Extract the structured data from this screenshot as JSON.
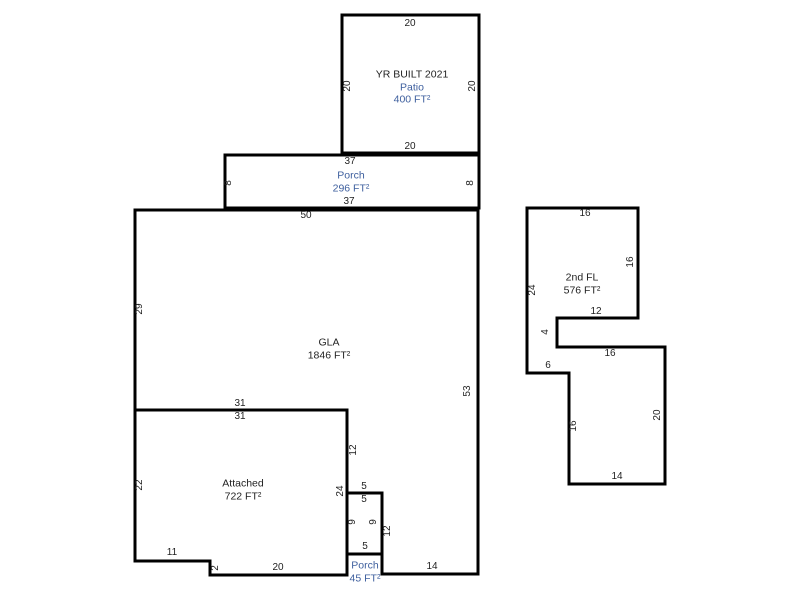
{
  "sketch": {
    "colors": {
      "background": "#ffffff",
      "wall": "#000000",
      "dimension_text": "#1f1f1f",
      "gla_label_text": "#1f1f1f",
      "non_gla_label_text": "#3e5f9e"
    },
    "areas": {
      "patio": {
        "note": "YR BUILT 2021",
        "name": "Patio",
        "size": "400 FT²"
      },
      "porch_upper": {
        "name": "Porch",
        "size": "296 FT²"
      },
      "gla": {
        "name": "GLA",
        "size": "1846 FT²"
      },
      "attached": {
        "name": "Attached",
        "size": "722 FT²"
      },
      "porch_lower": {
        "name": "Porch",
        "size": "45 FT²"
      },
      "second_floor": {
        "name": "2nd FL",
        "size": "576 FT²"
      }
    },
    "dimensions": [
      {
        "value": "20",
        "x": 410,
        "y": 24,
        "vertical": false,
        "edge": "patio-top"
      },
      {
        "value": "20",
        "x": 348,
        "y": 86,
        "vertical": true,
        "edge": "patio-left"
      },
      {
        "value": "20",
        "x": 473,
        "y": 86,
        "vertical": true,
        "edge": "patio-right"
      },
      {
        "value": "20",
        "x": 410,
        "y": 147,
        "vertical": false,
        "edge": "patio-bottom"
      },
      {
        "value": "37",
        "x": 350,
        "y": 162,
        "vertical": false,
        "edge": "porch-upper-top"
      },
      {
        "value": "8",
        "x": 229,
        "y": 183,
        "vertical": true,
        "edge": "porch-upper-left"
      },
      {
        "value": "8",
        "x": 471,
        "y": 183,
        "vertical": true,
        "edge": "porch-upper-right"
      },
      {
        "value": "37",
        "x": 349,
        "y": 202,
        "vertical": false,
        "edge": "porch-upper-bottom"
      },
      {
        "value": "50",
        "x": 306,
        "y": 216,
        "vertical": false,
        "edge": "gla-top"
      },
      {
        "value": "29",
        "x": 140,
        "y": 309,
        "vertical": true,
        "edge": "gla-left"
      },
      {
        "value": "53",
        "x": 468,
        "y": 391,
        "vertical": true,
        "edge": "gla-right"
      },
      {
        "value": "31",
        "x": 240,
        "y": 404,
        "vertical": false,
        "edge": "gla-bottom-left"
      },
      {
        "value": "12",
        "x": 354,
        "y": 450,
        "vertical": true,
        "edge": "gla-step-upper"
      },
      {
        "value": "5",
        "x": 364,
        "y": 487,
        "vertical": false,
        "edge": "gla-step-middle"
      },
      {
        "value": "12",
        "x": 388,
        "y": 531,
        "vertical": true,
        "edge": "gla-step-lower"
      },
      {
        "value": "14",
        "x": 432,
        "y": 567,
        "vertical": false,
        "edge": "gla-bottom-right"
      },
      {
        "value": "31",
        "x": 240,
        "y": 417,
        "vertical": false,
        "edge": "attached-top"
      },
      {
        "value": "22",
        "x": 140,
        "y": 485,
        "vertical": true,
        "edge": "attached-left"
      },
      {
        "value": "24",
        "x": 341,
        "y": 491,
        "vertical": true,
        "edge": "attached-right"
      },
      {
        "value": "11",
        "x": 172,
        "y": 553,
        "vertical": false,
        "edge": "attached-bottom-left"
      },
      {
        "value": "2",
        "x": 216,
        "y": 568,
        "vertical": true,
        "edge": "attached-step"
      },
      {
        "value": "20",
        "x": 278,
        "y": 568,
        "vertical": false,
        "edge": "attached-bottom-right"
      },
      {
        "value": "5",
        "x": 364,
        "y": 500,
        "vertical": false,
        "edge": "porch-lower-top"
      },
      {
        "value": "9",
        "x": 353,
        "y": 522,
        "vertical": true,
        "edge": "porch-lower-left"
      },
      {
        "value": "9",
        "x": 374,
        "y": 522,
        "vertical": true,
        "edge": "porch-lower-right"
      },
      {
        "value": "5",
        "x": 365,
        "y": 547,
        "vertical": false,
        "edge": "porch-lower-bottom"
      },
      {
        "value": "16",
        "x": 585,
        "y": 214,
        "vertical": false,
        "edge": "second-floor-top"
      },
      {
        "value": "24",
        "x": 533,
        "y": 290,
        "vertical": true,
        "edge": "second-floor-left"
      },
      {
        "value": "16",
        "x": 631,
        "y": 262,
        "vertical": true,
        "edge": "second-floor-upper-right"
      },
      {
        "value": "12",
        "x": 596,
        "y": 312,
        "vertical": false,
        "edge": "second-floor-notch-top"
      },
      {
        "value": "4",
        "x": 546,
        "y": 332,
        "vertical": true,
        "edge": "second-floor-notch-side"
      },
      {
        "value": "6",
        "x": 548,
        "y": 366,
        "vertical": false,
        "edge": "second-floor-lower-left-step"
      },
      {
        "value": "16",
        "x": 610,
        "y": 354,
        "vertical": false,
        "edge": "second-floor-middle"
      },
      {
        "value": "16",
        "x": 574,
        "y": 426,
        "vertical": true,
        "edge": "second-floor-lower-left"
      },
      {
        "value": "20",
        "x": 658,
        "y": 415,
        "vertical": true,
        "edge": "second-floor-lower-right"
      },
      {
        "value": "14",
        "x": 617,
        "y": 477,
        "vertical": false,
        "edge": "second-floor-bottom"
      }
    ]
  }
}
